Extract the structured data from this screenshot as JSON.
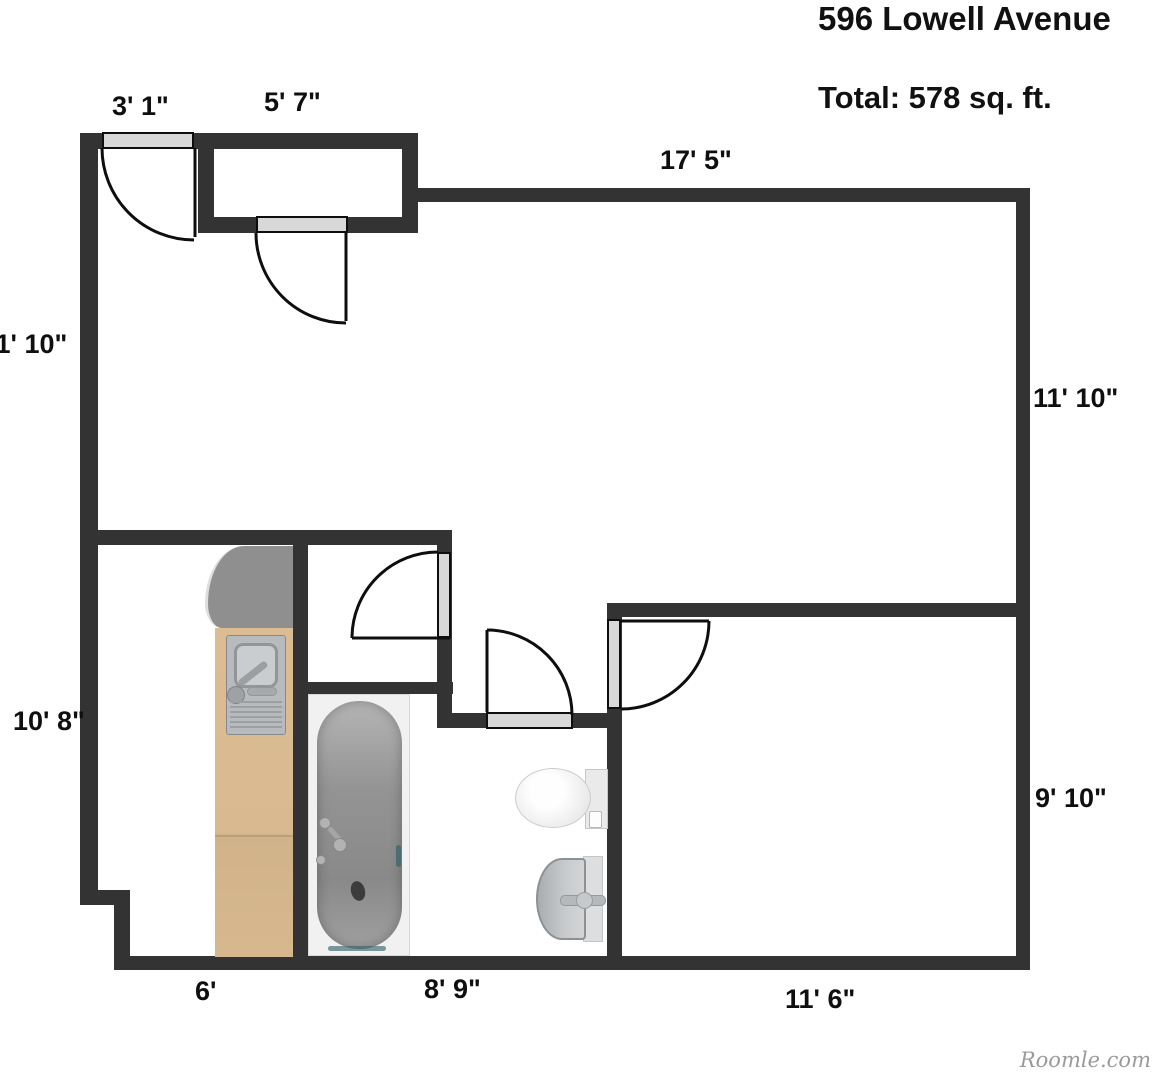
{
  "header": {
    "address": "596 Lowell Avenue",
    "total_area": "Total: 578 sq. ft."
  },
  "watermark": "Roomle.com",
  "dimension_labels": {
    "entry_door_width": "3' 1\"",
    "entry_closet_width": "5' 7\"",
    "living_room_width": "17' 5\"",
    "living_room_height_right": "11' 10\"",
    "living_room_height_left": "11' 10\"",
    "hall_kitchen_height": "10' 8\"",
    "kitchen_width": "6'",
    "bathroom_width": "8' 9\"",
    "bedroom_width": "11' 6\"",
    "bedroom_height": "9' 10\""
  },
  "fixtures": {
    "kitchen": [
      "corner-counter",
      "wood-counter",
      "kitchen-sink-unit"
    ],
    "bathroom": [
      "bathtub",
      "toilet",
      "wash-basin"
    ]
  },
  "doors": [
    "entry-door",
    "entry-closet-door",
    "storage-closet-door",
    "bathroom-door",
    "bedroom-door"
  ],
  "colors": {
    "wall": "#333333",
    "door_leaf": "#d8d8d8",
    "wood_counter": "#d9ba90",
    "counter_top": "#8f8f8f",
    "fixture_gray": "#b7bbbd",
    "text": "#0f0f0f",
    "watermark": "#9a9a9a",
    "accent_teal": "#39666b"
  }
}
